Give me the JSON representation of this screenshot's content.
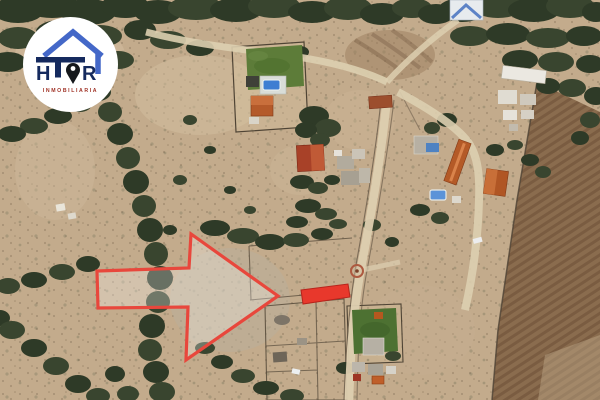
{
  "logo": {
    "brand_full": "HTOR",
    "brand_left": "H",
    "brand_right": "R",
    "tagline": "INMOBILIARIA",
    "colors": {
      "roof_blue": "#4468c8",
      "navy": "#152a5e",
      "pin_black": "#15181c",
      "tagline_red": "#a03226",
      "badge_bg": "#ffffff"
    }
  },
  "annotations": {
    "arrow_color": "#e8473c",
    "arrow_fill": "rgba(255,255,255,0.28)",
    "lot_fill": "#e8382c",
    "lot_stroke": "#b7241c",
    "waypoint_ring": "#ad5a40"
  },
  "map": {
    "view": "satellite-aerial",
    "terrain_tan": "#c3ab8c",
    "tree_green": "#2e3a27",
    "road_dirt": "#ddcfb0",
    "lawn_green": "#5d7c39",
    "pool_blue": "#3e7ed2",
    "roof_orange": "#b45a27",
    "plowed_field_brown": "#8a6c4e"
  }
}
